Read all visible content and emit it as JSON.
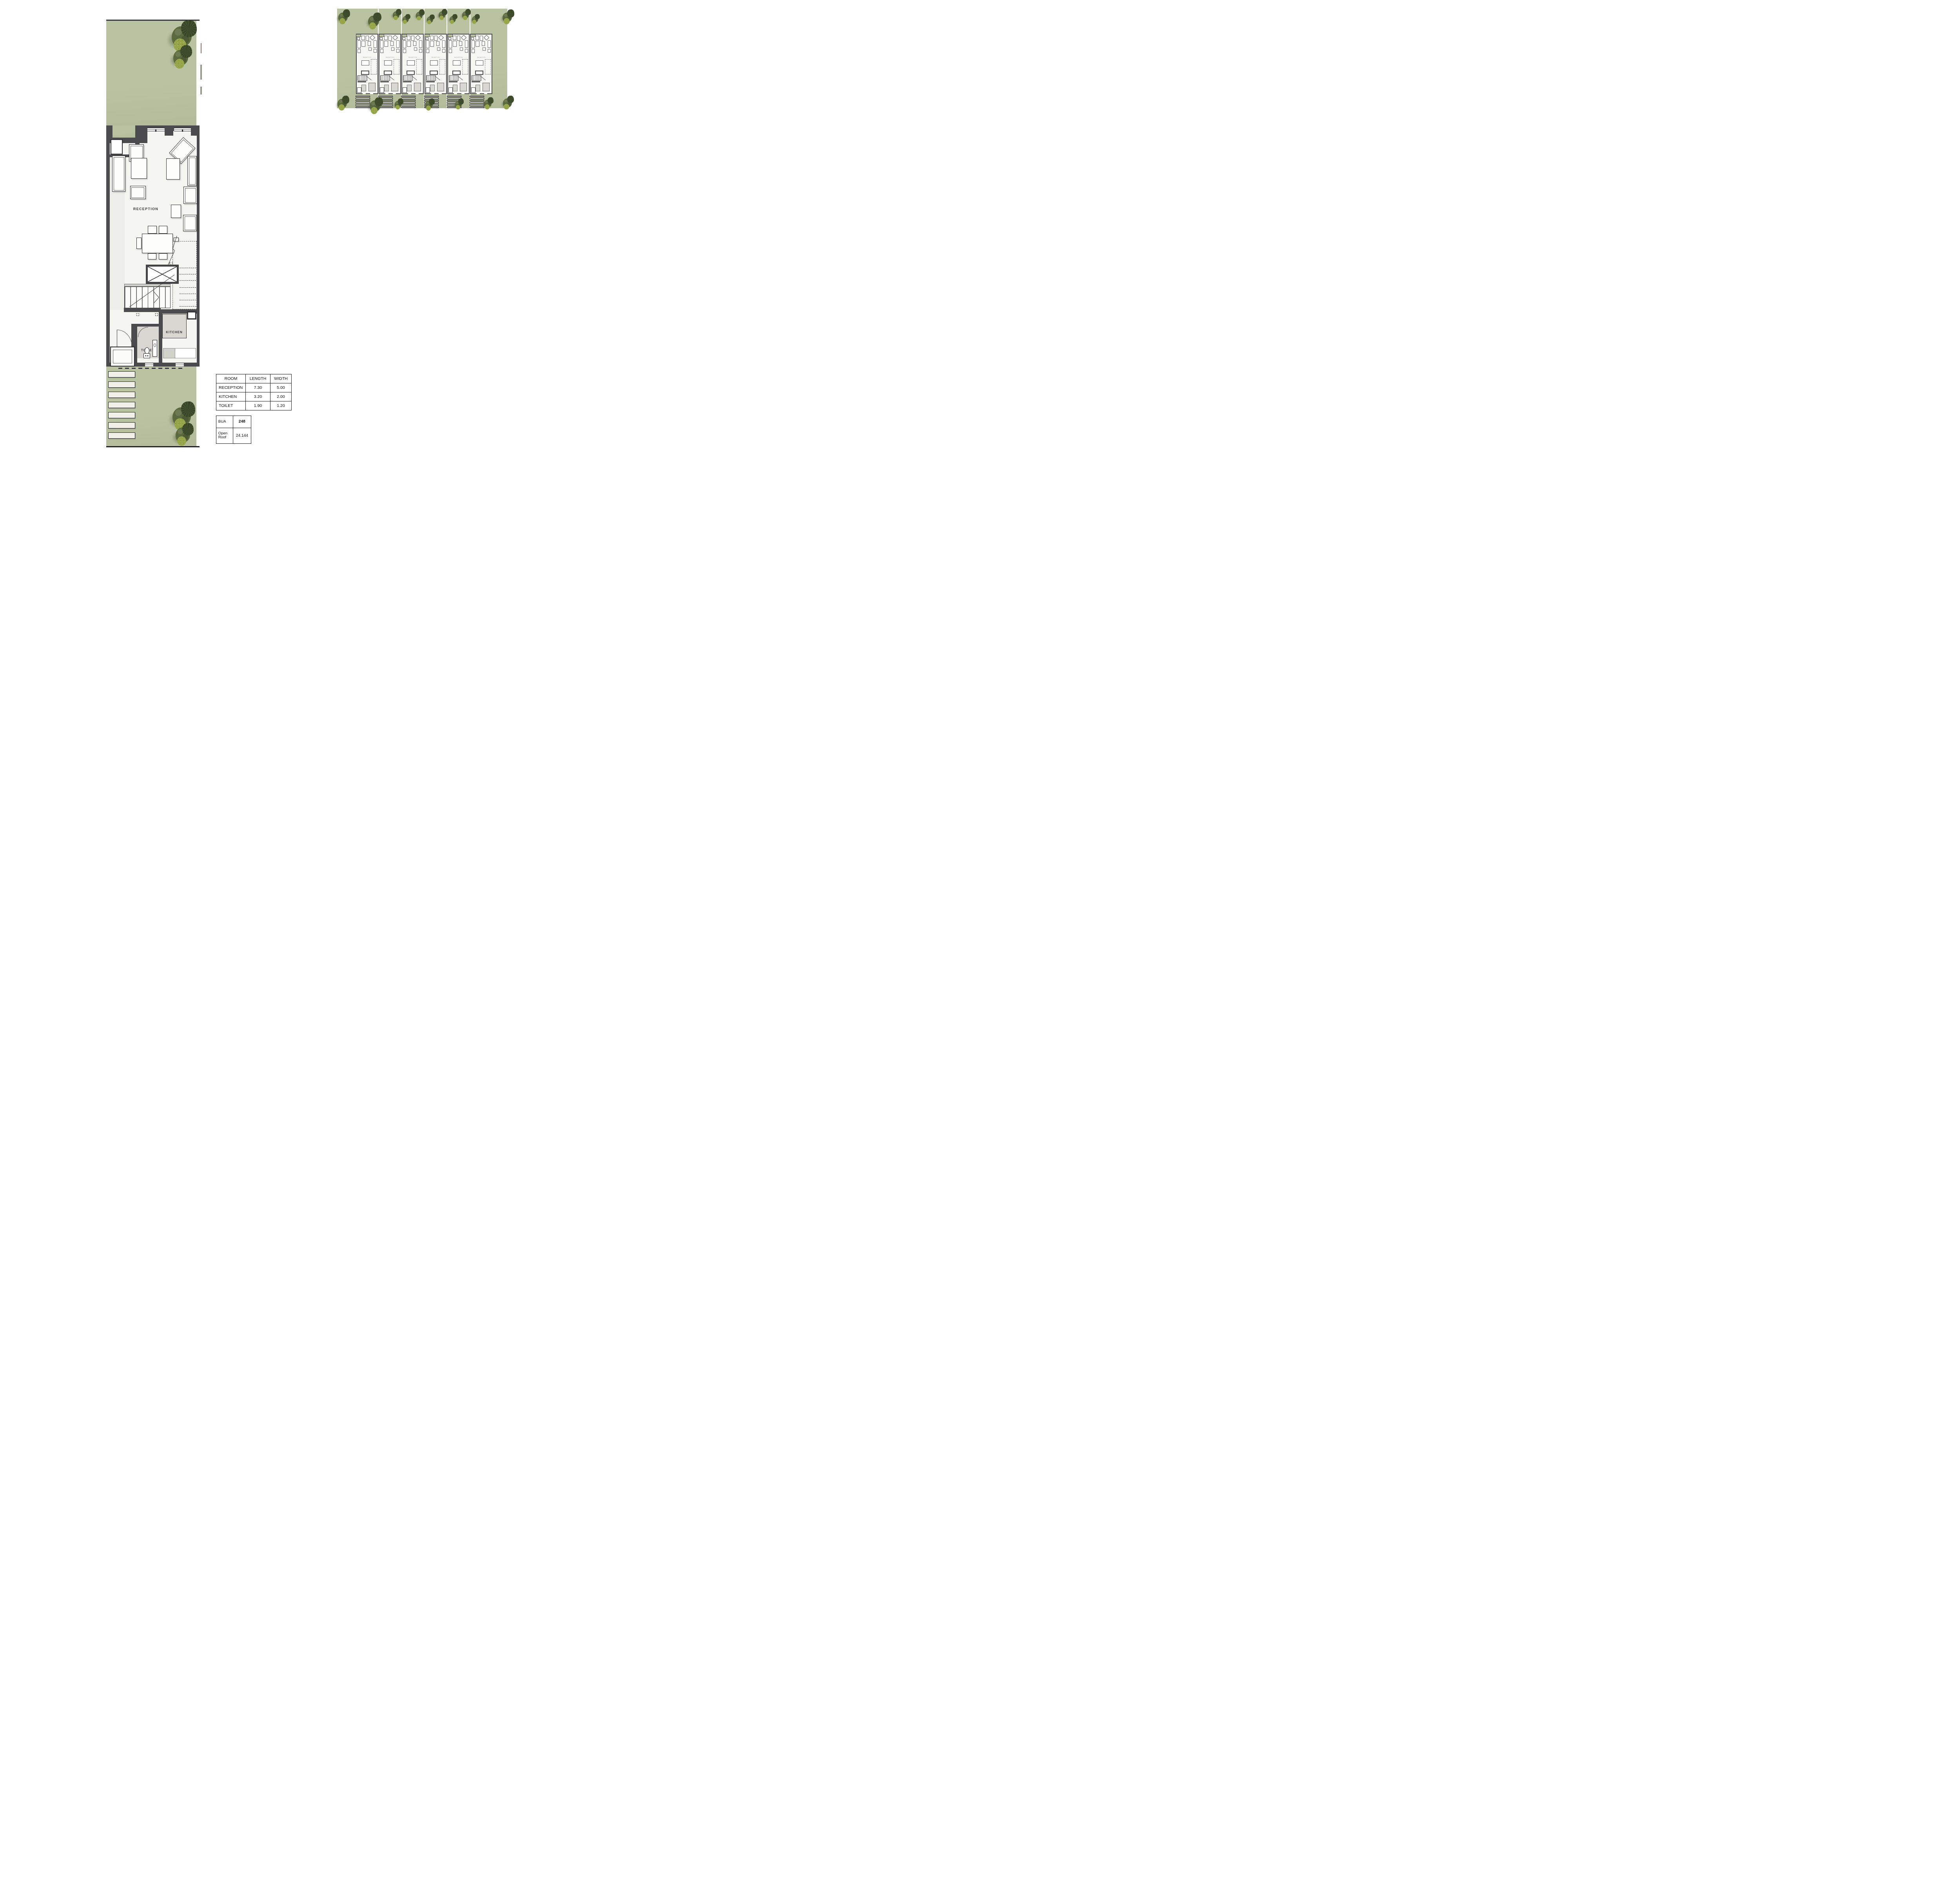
{
  "floor_plan": {
    "labels": {
      "reception": "RECEPTION",
      "kitchen": "KITCHEN",
      "toilet": "TOILET"
    }
  },
  "room_table": {
    "headers": [
      "ROOM",
      "LENGTH",
      "WIDTH"
    ],
    "rows": [
      {
        "room": "RECEPTION",
        "length": "7.30",
        "width": "5.00"
      },
      {
        "room": "KITCHEN",
        "length": "3.20",
        "width": "2.00"
      },
      {
        "room": "TOILET",
        "length": "1.90",
        "width": "1.20"
      }
    ]
  },
  "area_table": {
    "rows": [
      {
        "label": "BUA",
        "value": "248",
        "bold": true
      },
      {
        "label": "Open Roof",
        "value": "24.144",
        "bold": false
      }
    ]
  },
  "site_plan": {
    "unit_count": 6,
    "unit_label": "RECEPTION",
    "stepping_strips_per_unit": 6
  },
  "main_garden": {
    "stepping_stones": 7
  },
  "colors": {
    "wall": "#4b4b4d",
    "green": "#b9c2a1",
    "green2": "#b2bc9a",
    "gray": "#d8d7d2",
    "floor": "#f5f5f2",
    "tree_dark": "#42512e",
    "tree_mid": "#5b6a3e",
    "tree_light": "#96a549",
    "stone": "#f0f0e9",
    "ink": "#1c1c1c"
  }
}
